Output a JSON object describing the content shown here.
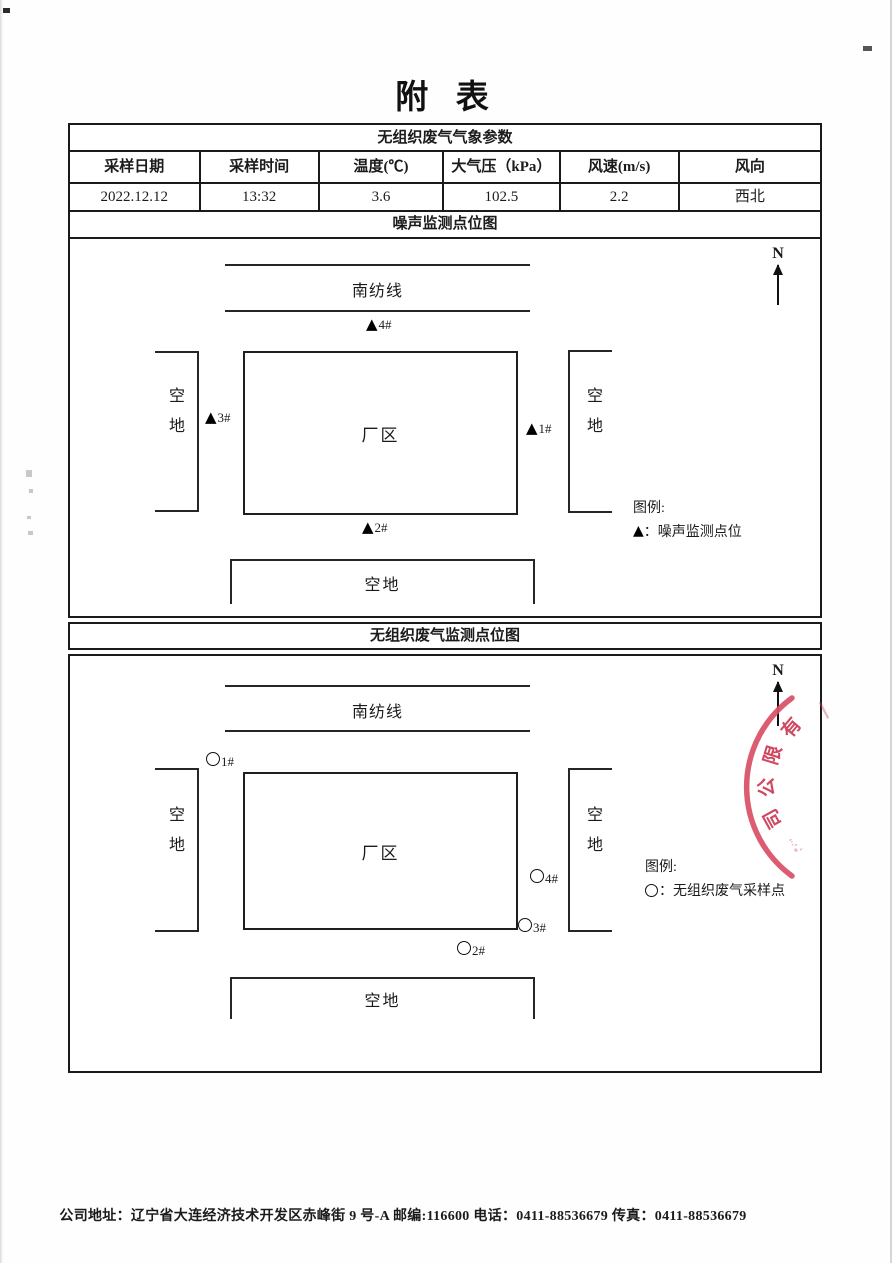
{
  "page_title": "附 表",
  "meteo_table": {
    "title": "无组织废气气象参数",
    "columns": [
      "采样日期",
      "采样时间",
      "温度(℃)",
      "大气压（kPa）",
      "风速(m/s)",
      "风向"
    ],
    "values": [
      "2022.12.12",
      "13:32",
      "3.6",
      "102.5",
      "2.2",
      "西北"
    ]
  },
  "noise_diagram": {
    "section_title": "噪声监测点位图",
    "north_label": "N",
    "road_label": "南纺线",
    "factory_label": "厂区",
    "left_area_label": "空地",
    "right_area_label": "空地",
    "bottom_area_label": "空地",
    "markers": [
      {
        "symbol": "▲",
        "label": "4#"
      },
      {
        "symbol": "▲",
        "label": "3#"
      },
      {
        "symbol": "▲",
        "label": "1#"
      },
      {
        "symbol": "▲",
        "label": "2#"
      }
    ],
    "legend": {
      "title": "图例:",
      "symbol": "▲",
      "text": "：噪声监测点位"
    }
  },
  "gas_diagram": {
    "section_title": "无组织废气监测点位图",
    "north_label": "N",
    "road_label": "南纺线",
    "factory_label": "厂区",
    "left_area_label": "空地",
    "right_area_label": "空地",
    "bottom_area_label": "空地",
    "markers": [
      {
        "label": "1#"
      },
      {
        "label": "4#"
      },
      {
        "label": "3#"
      },
      {
        "label": "2#"
      }
    ],
    "legend": {
      "title": "图例:",
      "text": "：无组织废气采样点"
    },
    "stamp_text": "有限公司"
  },
  "footer": {
    "text": "公司地址：辽宁省大连经济技术开发区赤峰街 9 号-A 邮编:116600 电话：0411-88536679 传真：0411-88536679"
  },
  "colors": {
    "stamp_red": "#d94f66",
    "ink": "#1b1b1b"
  }
}
